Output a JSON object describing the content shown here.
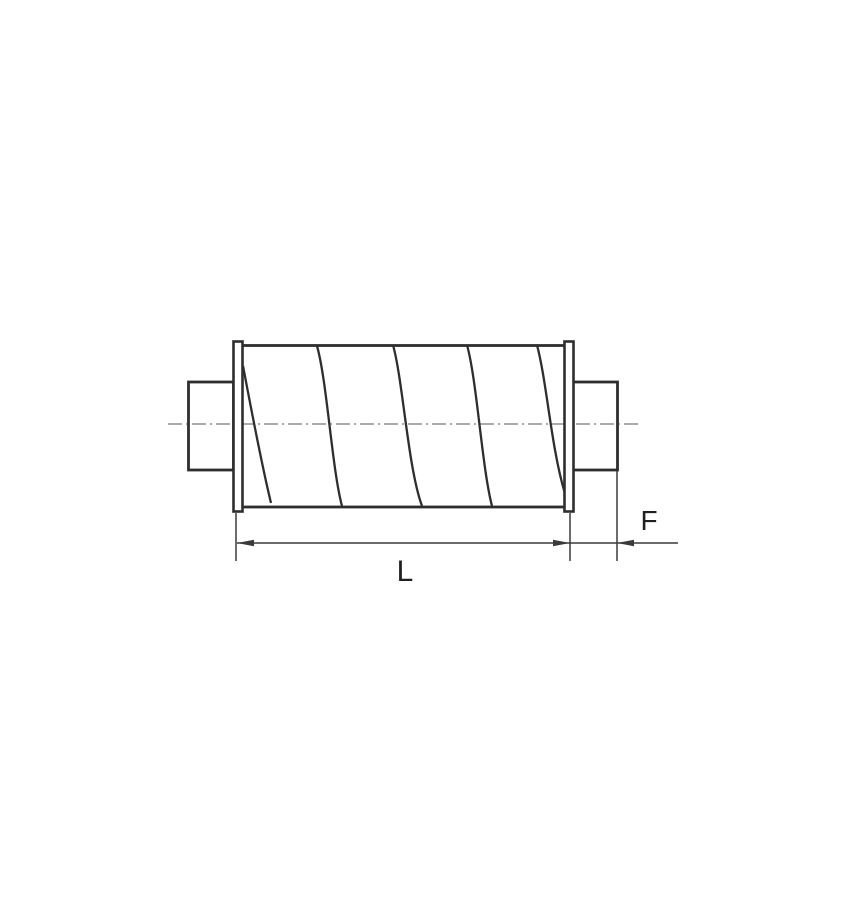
{
  "page": {
    "background": "#ffffff"
  },
  "drawing": {
    "kind": "technical-line-drawing",
    "subject": "duct-silencer-side-view",
    "labels": {
      "length_dimension": "L",
      "end_offset_dimension": "F"
    },
    "colors": {
      "outline": "#2e2e2e",
      "centerline": "#8f8f8f",
      "dimension": "#3a3a3a",
      "text": "#1f1f1f",
      "fill": "#ffffff"
    },
    "components": [
      "left-duct-spigot",
      "left-flange",
      "cylindrical-body-with-spiral-seams",
      "right-flange",
      "right-duct-spigot",
      "centerline",
      "length-dimension-L",
      "end-dimension-F"
    ]
  }
}
